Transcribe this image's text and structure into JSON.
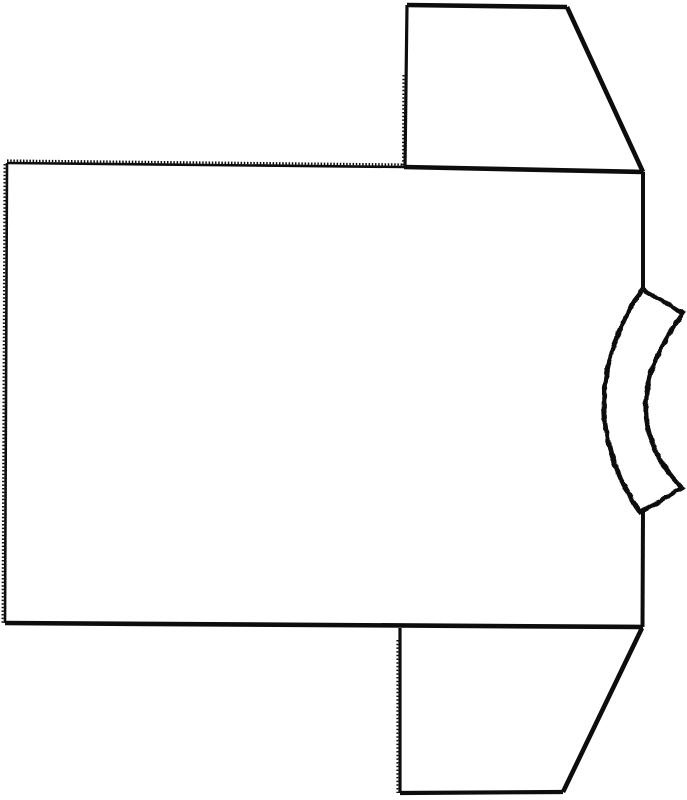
{
  "page": {
    "width": 687,
    "height": 800,
    "background_color": "#ffffff"
  },
  "figure": {
    "kind": "line-drawing",
    "subject": "t-shirt sewing pattern, rotated 90 degrees (collar at right)",
    "ink_color": "#0d0d0d",
    "parts": [
      {
        "name": "body-panel",
        "description": "large rectangle, serrated top edge, ticked left edge"
      },
      {
        "name": "top-sleeve",
        "description": "trapezoid attached to upper right of body"
      },
      {
        "name": "bottom-sleeve",
        "description": "trapezoid attached to lower right of body"
      },
      {
        "name": "neckband",
        "description": "curved rough-edged strip on middle right, bulging left"
      }
    ]
  },
  "drawing": {
    "viewbox": "0 0 687 800",
    "paths": [
      {
        "name": "body-top-edge-serrated-base",
        "part": "body-panel",
        "d": "M 7 163 L 405 167",
        "width": 2.6
      },
      {
        "name": "body-top-edge-serration-teeth",
        "part": "body-panel",
        "d": "M 7 160.6 L 405 164.6",
        "width": 2.4,
        "dash": "1.5 1.7"
      },
      {
        "name": "body-top-edge-solid",
        "part": "body-panel",
        "d": "M 404 167 L 643 172",
        "width": 4.6
      },
      {
        "name": "body-left-edge-base",
        "part": "body-panel",
        "d": "M 7 163 L 5 623",
        "width": 2.6
      },
      {
        "name": "body-left-edge-ticks",
        "part": "body-panel",
        "d": "M 4.6 164 L 2.6 623",
        "width": 2.2,
        "dash": "1.5 2.1"
      },
      {
        "name": "body-bottom-edge",
        "part": "body-panel",
        "d": "M 5 623 L 643 627",
        "width": 4.6
      },
      {
        "name": "body-right-edge-upper",
        "part": "body-panel",
        "d": "M 643 172 L 643 289",
        "width": 4.0
      },
      {
        "name": "body-right-edge-lower",
        "part": "body-panel",
        "d": "M 643 510 L 642.5 627",
        "width": 4.0
      },
      {
        "name": "top-sleeve-left-edge",
        "part": "top-sleeve",
        "d": "M 407 5 L 405 167",
        "width": 3.2
      },
      {
        "name": "top-sleeve-left-edge-ticks",
        "part": "top-sleeve",
        "d": "M 403.4 75 L 403 167",
        "width": 2.0,
        "dash": "1.5 2.2"
      },
      {
        "name": "top-sleeve-top-edge",
        "part": "top-sleeve",
        "d": "M 407 5 L 567 7",
        "width": 4.6
      },
      {
        "name": "top-sleeve-slant-edge",
        "part": "top-sleeve",
        "d": "M 567 7 L 643 172",
        "width": 4.6
      },
      {
        "name": "bottom-sleeve-left-edge",
        "part": "bottom-sleeve",
        "d": "M 400 628 L 400 793",
        "width": 3.2
      },
      {
        "name": "bottom-sleeve-left-edge-ticks",
        "part": "bottom-sleeve",
        "d": "M 397.4 640 L 397.4 793",
        "width": 2.0,
        "dash": "1.5 2.2"
      },
      {
        "name": "bottom-sleeve-bottom-edge",
        "part": "bottom-sleeve",
        "d": "M 400 793 L 563 792",
        "width": 4.2
      },
      {
        "name": "bottom-sleeve-slant-edge",
        "part": "bottom-sleeve",
        "d": "M 563 792 L 642 628",
        "width": 4.6
      },
      {
        "name": "neckband-outline",
        "part": "neckband",
        "d": "M 642 289 Q 567 405 640 512 L 682 488 Q 609 413 683 313 Z",
        "width": 4.6,
        "rough": true,
        "fill": "#ffffff"
      }
    ]
  }
}
